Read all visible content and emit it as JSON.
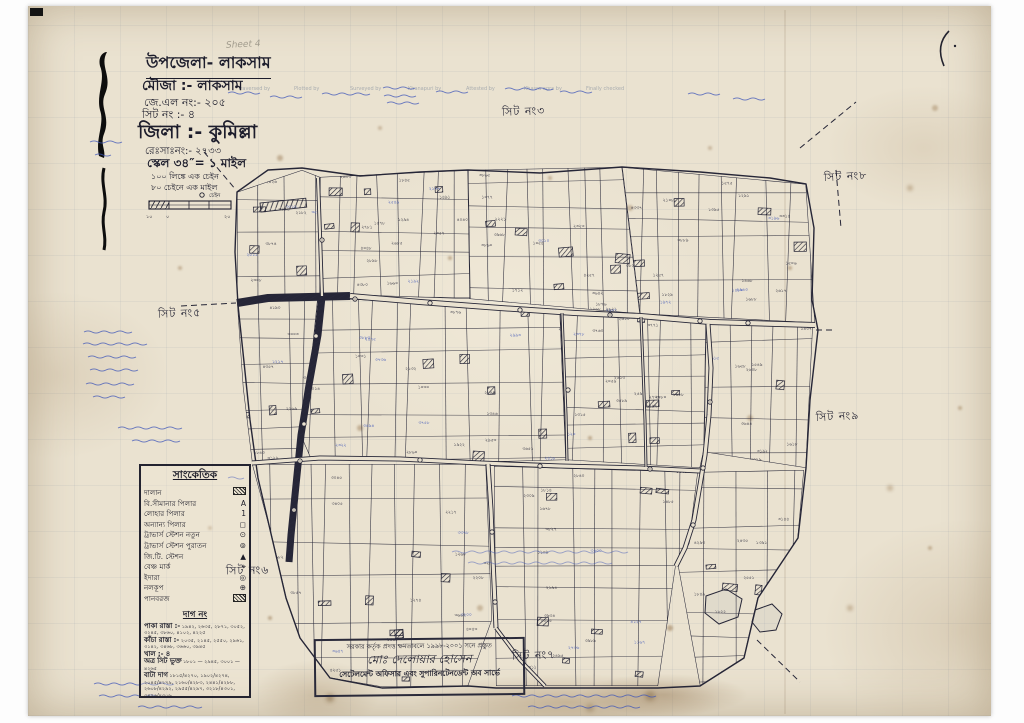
{
  "header": {
    "upazila": "উপজেলা- লাকসাম",
    "mouza": "মৌজা :-   লাকসাম",
    "jl_no": "জে.এল নং:- ২০৫",
    "sheet_no": "সিট নং :-    ৪",
    "district": "জিলা :-  কুমিল্লা",
    "resa_no": "রেঃসাঃনং:- ২৭৩৩",
    "scale": "স্কেল ৩৪″= ১ মাইল",
    "note1": "১০০ লিঙ্কে এক চেইন",
    "note2": "৮০ চেইনে এক মাইল",
    "scalebar": {
      "left": "১০",
      "zero": "০",
      "right": "২০",
      "unit": "চেইন"
    }
  },
  "annotations": {
    "pencil_note": "Sheet 4"
  },
  "form_columns": [
    {
      "t": "Traversed by",
      "x": 238
    },
    {
      "t": "Plotted by",
      "x": 294
    },
    {
      "t": "Surveyed by",
      "x": 350
    },
    {
      "t": "Khanapuri by",
      "x": 408
    },
    {
      "t": "Attested by",
      "x": 466
    },
    {
      "t": "Khasra agra by",
      "x": 524
    },
    {
      "t": "Finally checked",
      "x": 586
    }
  ],
  "sheet_labels": [
    {
      "text": "সিট নং৩",
      "x": 502,
      "y": 103,
      "r": -2
    },
    {
      "text": "সিট নং৮",
      "x": 824,
      "y": 168,
      "r": -3
    },
    {
      "text": "সিট নং৫",
      "x": 158,
      "y": 305,
      "r": -2
    },
    {
      "text": "সিট নং৯",
      "x": 816,
      "y": 408,
      "r": -3
    },
    {
      "text": "সিট নং৬",
      "x": 226,
      "y": 562,
      "r": -1
    },
    {
      "text": "সিট নং৭",
      "x": 512,
      "y": 647,
      "r": -2
    }
  ],
  "legend": {
    "title": "সাংকেতিক",
    "items": [
      {
        "label": "দালান",
        "sym": "hatch"
      },
      {
        "label": "বি.সীমানার পিলার",
        "sym": "A"
      },
      {
        "label": "লোহার পিলার",
        "sym": "1"
      },
      {
        "label": "অন্যান্য পিলার",
        "sym": "◻"
      },
      {
        "label": "ট্রাভার্স স্টেশন নতুন",
        "sym": "⊙"
      },
      {
        "label": "ট্রাভার্স স্টেশন পুরাতন",
        "sym": "⊚"
      },
      {
        "label": "জি.টি. স্টেশন",
        "sym": "▲"
      },
      {
        "label": "বেঞ্চ মার্ক",
        "sym": "⌖"
      },
      {
        "label": "ইদারা",
        "sym": "◎"
      },
      {
        "label": "নলকূপ",
        "sym": "⊕"
      },
      {
        "label": "পানবরজ",
        "sym": "hatch"
      }
    ],
    "dag_title": "দাগ নং",
    "dag_rows": [
      {
        "label": "পাকা রাস্তা :-",
        "nums": "১৯৪২, ২৬৩৫, ২৮৭১, ৩০৫২, ৩২৪৫, ৩৮৬০, ৪১০২, ৪২২৫"
      },
      {
        "label": "কাঁচা রাস্তা :-",
        "nums": "২০৩৫, ২১৪৫, ২৫৫০, ২৯৬১, ৩১৪২, ৩৪৬৮, ৩৬৬০, ৩৯৪৫"
      },
      {
        "label": "খাল :- ৪",
        "nums": ""
      },
      {
        "label": "অত্র সিট ভুক্ত",
        "nums": "১৮০১ — ২৯৪৫, ৩০০১ — ৪২৬৫"
      },
      {
        "label": "বাটা দাগ",
        "nums": "১৮১৫/৪২৭০, ১৯০২/৪২৭৪, ২০৪৫/৪২৭৯, ২১৬০/৪২৮৩, ২৪৪১/৪২৮৮, ২৬০৮/৪২৯২, ২৯৫৫/৪২৯৭, ৩২১৮/৪৩০১, ৩৪৭৬/৪৩০৬"
      }
    ]
  },
  "stamp": {
    "line1": "সরকার কর্তৃক প্রদত্ত ক্ষমতাবলে ১৯৯৮-২০০১ সনে প্রস্তুত",
    "line2": "মোঃ দেলোয়ার হোসেন",
    "line3": "সেটেলমেন্ট অফিসার এবং সুপারিনটেনডেন্ট অব সার্ভে"
  },
  "map": {
    "boundary": [
      [
        237,
        192
      ],
      [
        268,
        170
      ],
      [
        302,
        168
      ],
      [
        360,
        176
      ],
      [
        420,
        172
      ],
      [
        468,
        170
      ],
      [
        540,
        173
      ],
      [
        622,
        167
      ],
      [
        700,
        172
      ],
      [
        770,
        178
      ],
      [
        806,
        184
      ],
      [
        814,
        228
      ],
      [
        812,
        300
      ],
      [
        818,
        330
      ],
      [
        810,
        400
      ],
      [
        806,
        468
      ],
      [
        798,
        538
      ],
      [
        758,
        598
      ],
      [
        744,
        658
      ],
      [
        700,
        686
      ],
      [
        658,
        688
      ],
      [
        560,
        688
      ],
      [
        496,
        688
      ],
      [
        468,
        686
      ],
      [
        382,
        688
      ],
      [
        330,
        678
      ],
      [
        300,
        638
      ],
      [
        286,
        598
      ],
      [
        272,
        538
      ],
      [
        258,
        478
      ],
      [
        250,
        420
      ],
      [
        244,
        362
      ],
      [
        238,
        305
      ],
      [
        235,
        252
      ]
    ],
    "roads": [
      {
        "pts": [
          [
            237,
            303
          ],
          [
            268,
            298
          ],
          [
            350,
            296
          ]
        ],
        "w": 8,
        "hatch": true
      },
      {
        "pts": [
          [
            350,
            296
          ],
          [
            420,
            302
          ],
          [
            500,
            308
          ],
          [
            575,
            313
          ],
          [
            640,
            316
          ],
          [
            710,
            322
          ],
          [
            815,
            325
          ]
        ],
        "w": 6,
        "hatch": false
      },
      {
        "pts": [
          [
            322,
            297
          ],
          [
            318,
            335
          ],
          [
            309,
            385
          ],
          [
            301,
            435
          ],
          [
            296,
            485
          ],
          [
            291,
            535
          ],
          [
            289,
            562
          ]
        ],
        "w": 7,
        "hatch": true
      },
      {
        "pts": [
          [
            252,
            463
          ],
          [
            320,
            458
          ],
          [
            400,
            459
          ],
          [
            480,
            463
          ],
          [
            560,
            466
          ],
          [
            640,
            468
          ],
          [
            700,
            471
          ]
        ],
        "w": 5,
        "hatch": false
      },
      {
        "pts": [
          [
            488,
            464
          ],
          [
            491,
            510
          ],
          [
            493,
            560
          ],
          [
            495,
            605
          ],
          [
            496,
            628
          ]
        ],
        "w": 5,
        "hatch": false
      },
      {
        "pts": [
          [
            708,
            324
          ],
          [
            711,
            368
          ],
          [
            709,
            415
          ],
          [
            705,
            455
          ],
          [
            700,
            485
          ],
          [
            694,
            520
          ],
          [
            685,
            548
          ],
          [
            676,
            566
          ]
        ],
        "w": 5,
        "hatch": false
      },
      {
        "pts": [
          [
            562,
            313
          ],
          [
            564,
            365
          ],
          [
            566,
            415
          ],
          [
            567,
            461
          ]
        ],
        "w": 3,
        "hatch": false
      },
      {
        "pts": [
          [
            641,
            317
          ],
          [
            643,
            368
          ],
          [
            645,
            420
          ],
          [
            646,
            467
          ]
        ],
        "w": 3,
        "hatch": false
      },
      {
        "pts": [
          [
            318,
            178
          ],
          [
            320,
            235
          ],
          [
            322,
            296
          ]
        ],
        "w": 4,
        "hatch": false
      },
      {
        "pts": [
          [
            496,
            628
          ],
          [
            520,
            660
          ],
          [
            545,
            686
          ]
        ],
        "w": 4,
        "hatch": false
      }
    ],
    "blocks": [
      {
        "poly": [
          [
            237,
            192
          ],
          [
            302,
            170
          ],
          [
            320,
            177
          ],
          [
            320,
            294
          ],
          [
            237,
            302
          ]
        ],
        "vstep": 24,
        "hstep": 34,
        "labels": 10,
        "bld": 3,
        "seed": 11
      },
      {
        "poly": [
          [
            320,
            177
          ],
          [
            468,
            170
          ],
          [
            470,
            299
          ],
          [
            320,
            294
          ]
        ],
        "vstep": 22,
        "hstep": 30,
        "labels": 16,
        "bld": 5,
        "seed": 22
      },
      {
        "poly": [
          [
            468,
            170
          ],
          [
            622,
            167
          ],
          [
            640,
            314
          ],
          [
            470,
            299
          ]
        ],
        "vstep": 20,
        "hstep": 28,
        "labels": 18,
        "bld": 6,
        "seed": 33
      },
      {
        "poly": [
          [
            622,
            167
          ],
          [
            806,
            184
          ],
          [
            815,
            323
          ],
          [
            640,
            314
          ]
        ],
        "vstep": 20,
        "hstep": 30,
        "labels": 18,
        "bld": 6,
        "seed": 44
      },
      {
        "poly": [
          [
            237,
            302
          ],
          [
            318,
            297
          ],
          [
            309,
            384
          ],
          [
            300,
            434
          ],
          [
            296,
            460
          ],
          [
            252,
            462
          ],
          [
            243,
            388
          ]
        ],
        "vstep": 26,
        "hstep": 30,
        "labels": 8,
        "bld": 2,
        "seed": 55
      },
      {
        "poly": [
          [
            318,
            297
          ],
          [
            560,
            311
          ],
          [
            566,
            460
          ],
          [
            488,
            462
          ],
          [
            310,
            457
          ],
          [
            300,
            434
          ],
          [
            309,
            384
          ]
        ],
        "vstep": 24,
        "hstep": 32,
        "labels": 22,
        "bld": 8,
        "seed": 66
      },
      {
        "poly": [
          [
            560,
            311
          ],
          [
            706,
            320
          ],
          [
            704,
            450
          ],
          [
            700,
            468
          ],
          [
            566,
            460
          ]
        ],
        "vstep": 22,
        "hstep": 30,
        "labels": 14,
        "bld": 6,
        "seed": 77
      },
      {
        "poly": [
          [
            706,
            320
          ],
          [
            813,
            323
          ],
          [
            806,
            468
          ],
          [
            704,
            452
          ]
        ],
        "vstep": 24,
        "hstep": 32,
        "labels": 9,
        "bld": 3,
        "seed": 88
      },
      {
        "poly": [
          [
            252,
            464
          ],
          [
            486,
            464
          ],
          [
            492,
            620
          ],
          [
            468,
            686
          ],
          [
            382,
            687
          ],
          [
            330,
            678
          ],
          [
            300,
            638
          ],
          [
            286,
            598
          ],
          [
            272,
            538
          ]
        ],
        "vstep": 26,
        "hstep": 34,
        "labels": 20,
        "bld": 7,
        "seed": 99
      },
      {
        "poly": [
          [
            494,
            466
          ],
          [
            698,
            472
          ],
          [
            689,
            543
          ],
          [
            676,
            564
          ],
          [
            658,
            686
          ],
          [
            560,
            686
          ],
          [
            496,
            686
          ]
        ],
        "vstep": 24,
        "hstep": 32,
        "labels": 18,
        "bld": 7,
        "seed": 111
      },
      {
        "poly": [
          [
            700,
            472
          ],
          [
            804,
            470
          ],
          [
            798,
            538
          ],
          [
            758,
            598
          ],
          [
            744,
            658
          ],
          [
            700,
            686
          ],
          [
            678,
            566
          ],
          [
            689,
            543
          ]
        ],
        "vstep": 26,
        "hstep": 32,
        "labels": 10,
        "bld": 3,
        "seed": 122
      }
    ],
    "wells": [
      [
        355,
        299
      ],
      [
        430,
        303
      ],
      [
        520,
        310
      ],
      [
        610,
        315
      ],
      [
        700,
        321
      ],
      [
        748,
        323
      ],
      [
        300,
        461
      ],
      [
        420,
        460
      ],
      [
        540,
        466
      ],
      [
        650,
        469
      ],
      [
        316,
        336
      ],
      [
        304,
        424
      ],
      [
        294,
        510
      ],
      [
        492,
        532
      ],
      [
        495,
        602
      ],
      [
        710,
        402
      ],
      [
        703,
        468
      ],
      [
        693,
        525
      ],
      [
        322,
        240
      ],
      [
        568,
        390
      ]
    ],
    "ladders": [
      {
        "x": 260,
        "y": 203,
        "w": 46,
        "h": 9,
        "r": -6
      }
    ],
    "ponds": [
      [
        [
          706,
          596
        ],
        [
          726,
          589
        ],
        [
          742,
          599
        ],
        [
          738,
          617
        ],
        [
          719,
          624
        ],
        [
          705,
          613
        ]
      ],
      [
        [
          755,
          610
        ],
        [
          772,
          604
        ],
        [
          782,
          614
        ],
        [
          776,
          630
        ],
        [
          760,
          632
        ],
        [
          752,
          622
        ]
      ]
    ],
    "dashes": [
      [
        [
          800,
          148
        ],
        [
          856,
          102
        ]
      ],
      [
        [
          836,
          170
        ],
        [
          841,
          228
        ]
      ],
      [
        [
          204,
          152
        ],
        [
          236,
          190
        ]
      ],
      [
        [
          181,
          306
        ],
        [
          236,
          303
        ]
      ],
      [
        [
          757,
          640
        ],
        [
          800,
          682
        ]
      ],
      [
        [
          816,
          330
        ],
        [
          836,
          330
        ]
      ]
    ],
    "scribbles": [
      {
        "x": 228,
        "y": 93,
        "w": 34
      },
      {
        "x": 270,
        "y": 97,
        "w": 30
      },
      {
        "x": 322,
        "y": 94,
        "w": 40
      },
      {
        "x": 383,
        "y": 88,
        "w": 26
      },
      {
        "x": 384,
        "y": 96,
        "w": 30
      },
      {
        "x": 387,
        "y": 103,
        "w": 26
      },
      {
        "x": 436,
        "y": 92,
        "w": 38
      },
      {
        "x": 505,
        "y": 89,
        "w": 42
      },
      {
        "x": 560,
        "y": 92,
        "w": 34
      },
      {
        "x": 688,
        "y": 94,
        "w": 26
      },
      {
        "x": 733,
        "y": 99,
        "w": 24
      },
      {
        "x": 84,
        "y": 332,
        "w": 52
      },
      {
        "x": 83,
        "y": 344,
        "w": 58
      },
      {
        "x": 88,
        "y": 357,
        "w": 48
      },
      {
        "x": 90,
        "y": 370,
        "w": 44
      },
      {
        "x": 86,
        "y": 384,
        "w": 52
      },
      {
        "x": 93,
        "y": 397,
        "w": 38
      },
      {
        "x": 90,
        "y": 142,
        "w": 26
      },
      {
        "x": 95,
        "y": 155,
        "w": 22
      },
      {
        "x": 118,
        "y": 428,
        "w": 64
      },
      {
        "x": 132,
        "y": 441,
        "w": 48
      },
      {
        "x": 228,
        "y": 478,
        "w": 20
      },
      {
        "x": 94,
        "y": 684,
        "w": 72
      },
      {
        "x": 99,
        "y": 696,
        "w": 64
      },
      {
        "x": 138,
        "y": 707,
        "w": 56
      },
      {
        "x": 452,
        "y": 552,
        "w": 180,
        "o": 0.5
      },
      {
        "x": 468,
        "y": 563,
        "w": 150,
        "o": 0.5
      },
      {
        "x": 512,
        "y": 696,
        "w": 150
      },
      {
        "x": 528,
        "y": 707,
        "w": 118
      }
    ]
  }
}
